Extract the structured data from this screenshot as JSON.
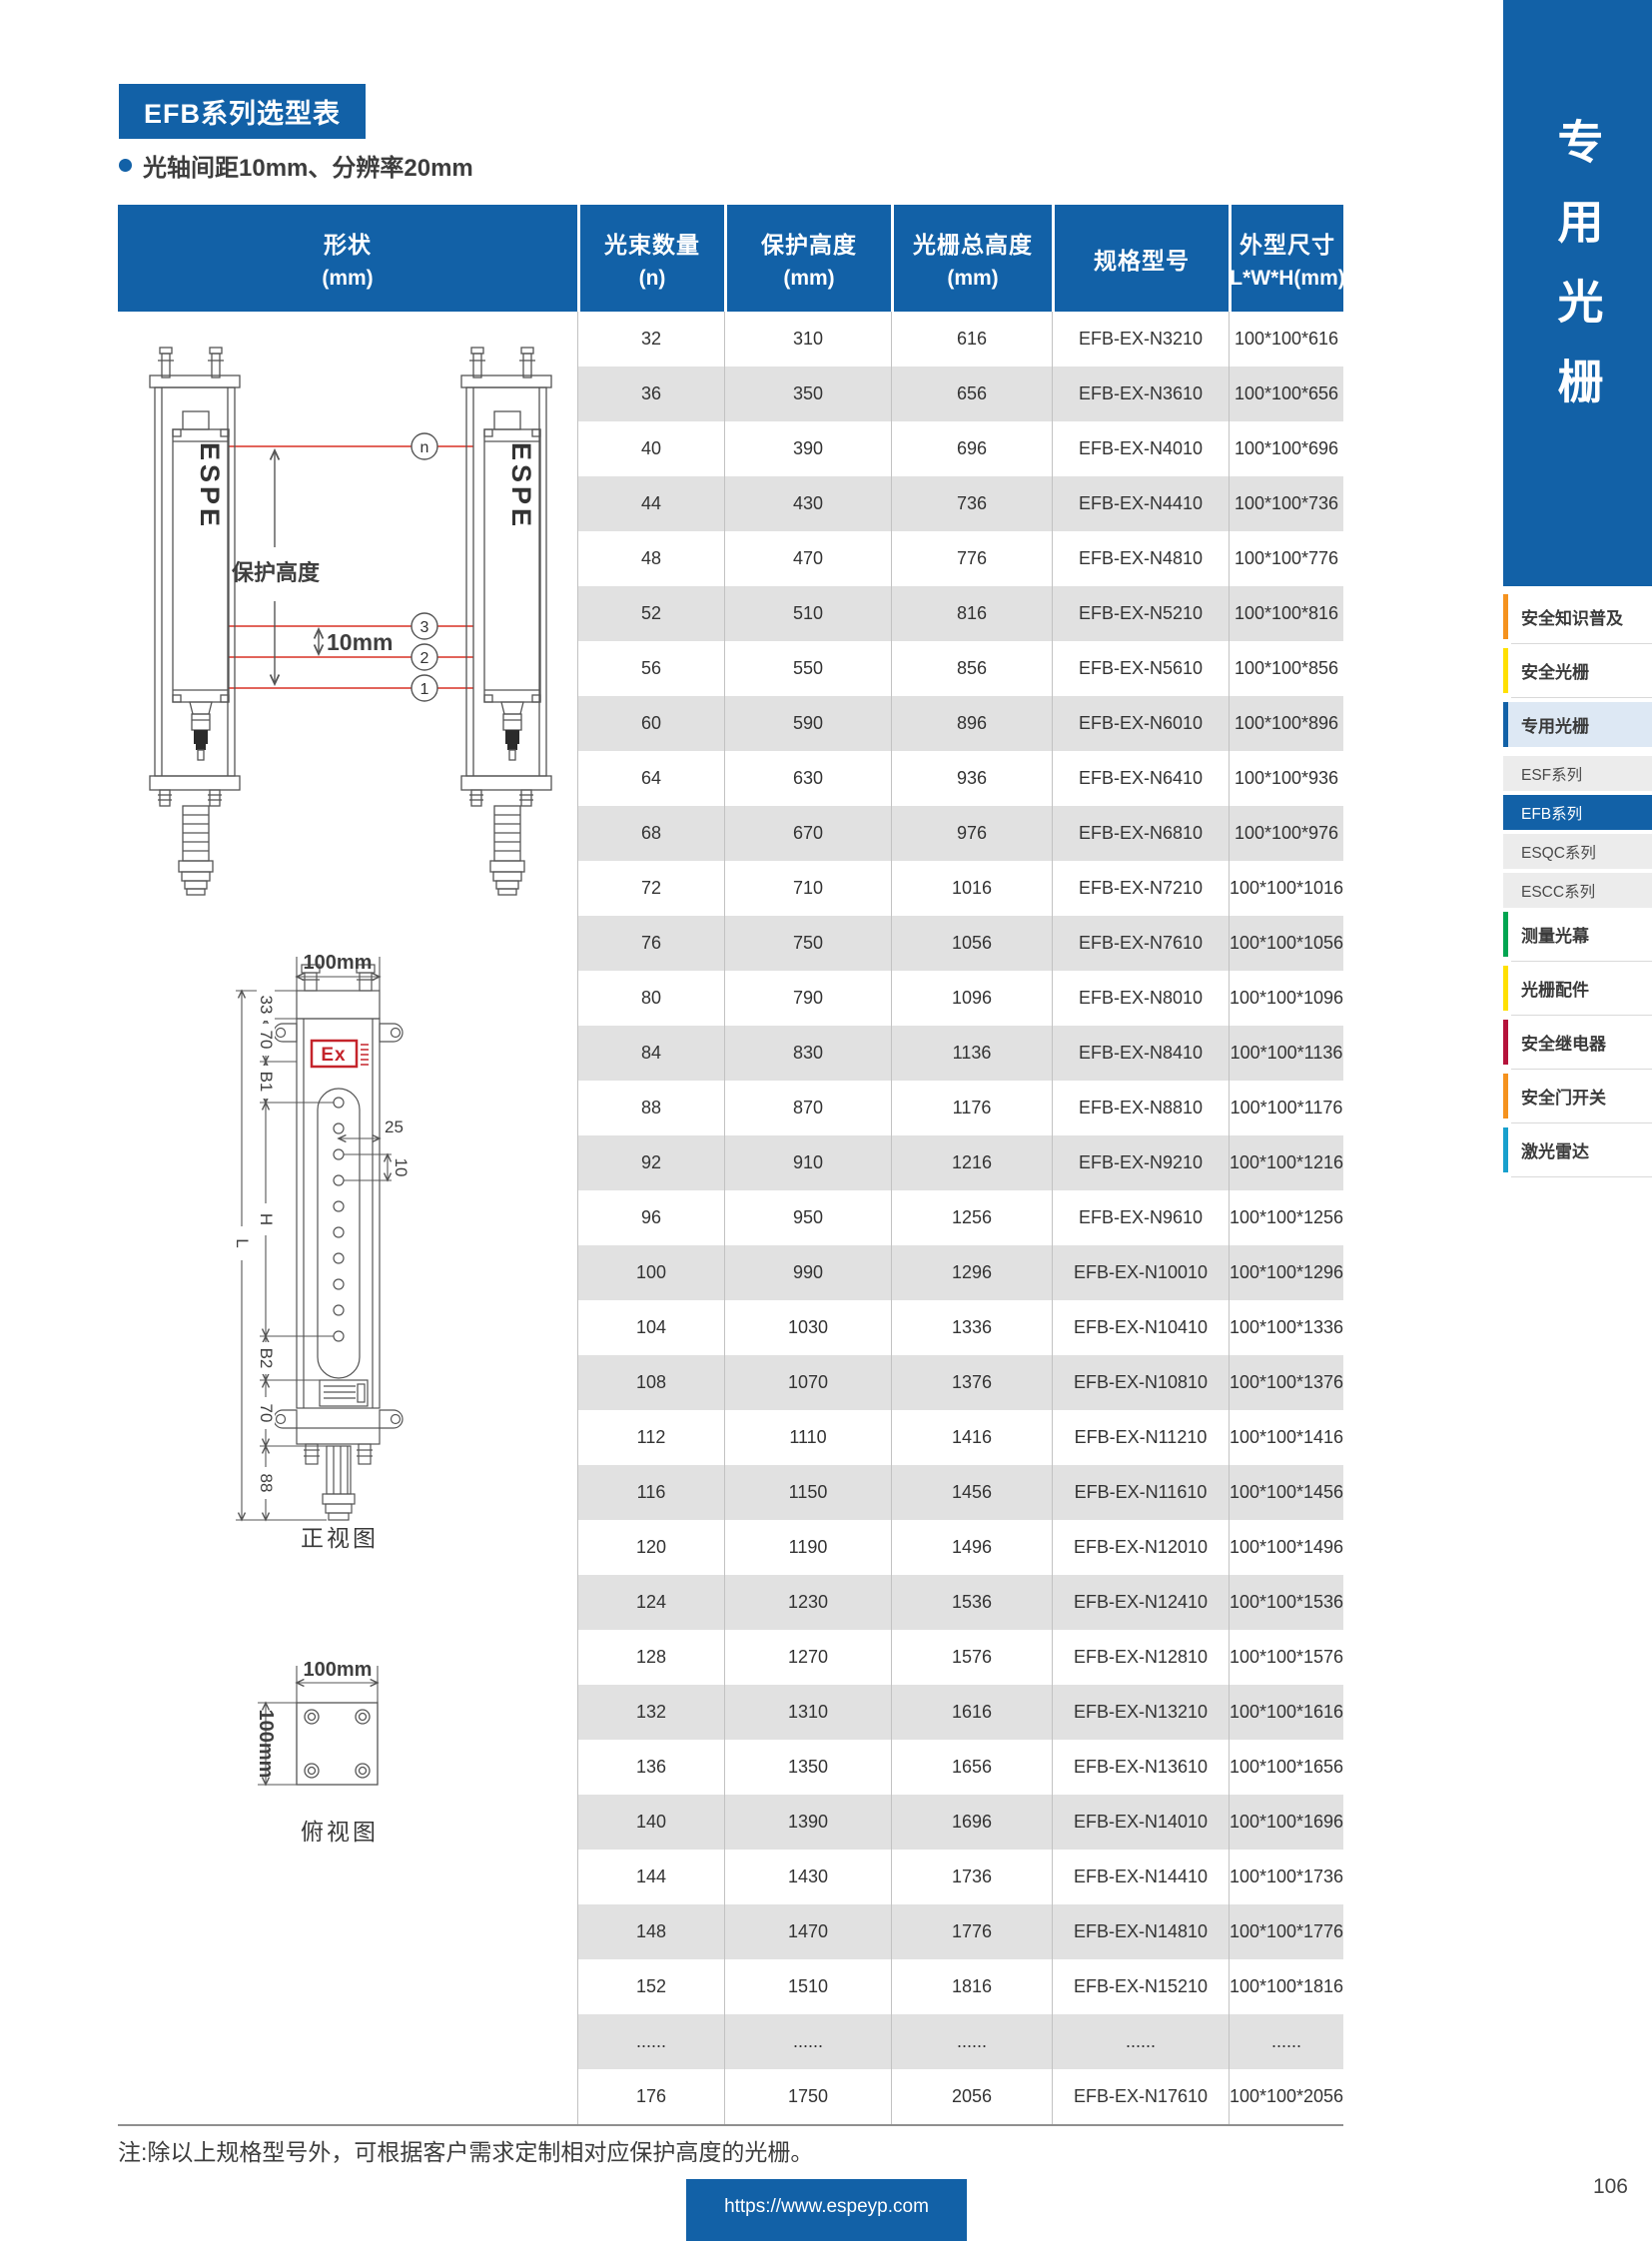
{
  "page": {
    "title": "EFB系列选型表",
    "subtitle": "光轴间距10mm、分辨率20mm",
    "note": "注:除以上规格型号外，可根据客户需求定制相对应保护高度的光栅。",
    "footer_url": "https://www.espeyp.com",
    "page_number": "106"
  },
  "table": {
    "headers": [
      {
        "line1": "形状",
        "line2": "(mm)"
      },
      {
        "line1": "光束数量",
        "line2": "(n)"
      },
      {
        "line1": "保护高度",
        "line2": "(mm)"
      },
      {
        "line1": "光栅总高度",
        "line2": "(mm)"
      },
      {
        "line1": "规格型号",
        "line2": ""
      },
      {
        "line1": "外型尺寸",
        "line2": "L*W*H(mm)"
      }
    ],
    "rows": [
      [
        "32",
        "310",
        "616",
        "EFB-EX-N3210",
        "100*100*616"
      ],
      [
        "36",
        "350",
        "656",
        "EFB-EX-N3610",
        "100*100*656"
      ],
      [
        "40",
        "390",
        "696",
        "EFB-EX-N4010",
        "100*100*696"
      ],
      [
        "44",
        "430",
        "736",
        "EFB-EX-N4410",
        "100*100*736"
      ],
      [
        "48",
        "470",
        "776",
        "EFB-EX-N4810",
        "100*100*776"
      ],
      [
        "52",
        "510",
        "816",
        "EFB-EX-N5210",
        "100*100*816"
      ],
      [
        "56",
        "550",
        "856",
        "EFB-EX-N5610",
        "100*100*856"
      ],
      [
        "60",
        "590",
        "896",
        "EFB-EX-N6010",
        "100*100*896"
      ],
      [
        "64",
        "630",
        "936",
        "EFB-EX-N6410",
        "100*100*936"
      ],
      [
        "68",
        "670",
        "976",
        "EFB-EX-N6810",
        "100*100*976"
      ],
      [
        "72",
        "710",
        "1016",
        "EFB-EX-N7210",
        "100*100*1016"
      ],
      [
        "76",
        "750",
        "1056",
        "EFB-EX-N7610",
        "100*100*1056"
      ],
      [
        "80",
        "790",
        "1096",
        "EFB-EX-N8010",
        "100*100*1096"
      ],
      [
        "84",
        "830",
        "1136",
        "EFB-EX-N8410",
        "100*100*1136"
      ],
      [
        "88",
        "870",
        "1176",
        "EFB-EX-N8810",
        "100*100*1176"
      ],
      [
        "92",
        "910",
        "1216",
        "EFB-EX-N9210",
        "100*100*1216"
      ],
      [
        "96",
        "950",
        "1256",
        "EFB-EX-N9610",
        "100*100*1256"
      ],
      [
        "100",
        "990",
        "1296",
        "EFB-EX-N10010",
        "100*100*1296"
      ],
      [
        "104",
        "1030",
        "1336",
        "EFB-EX-N10410",
        "100*100*1336"
      ],
      [
        "108",
        "1070",
        "1376",
        "EFB-EX-N10810",
        "100*100*1376"
      ],
      [
        "112",
        "1110",
        "1416",
        "EFB-EX-N11210",
        "100*100*1416"
      ],
      [
        "116",
        "1150",
        "1456",
        "EFB-EX-N11610",
        "100*100*1456"
      ],
      [
        "120",
        "1190",
        "1496",
        "EFB-EX-N12010",
        "100*100*1496"
      ],
      [
        "124",
        "1230",
        "1536",
        "EFB-EX-N12410",
        "100*100*1536"
      ],
      [
        "128",
        "1270",
        "1576",
        "EFB-EX-N12810",
        "100*100*1576"
      ],
      [
        "132",
        "1310",
        "1616",
        "EFB-EX-N13210",
        "100*100*1616"
      ],
      [
        "136",
        "1350",
        "1656",
        "EFB-EX-N13610",
        "100*100*1656"
      ],
      [
        "140",
        "1390",
        "1696",
        "EFB-EX-N14010",
        "100*100*1696"
      ],
      [
        "144",
        "1430",
        "1736",
        "EFB-EX-N14410",
        "100*100*1736"
      ],
      [
        "148",
        "1470",
        "1776",
        "EFB-EX-N14810",
        "100*100*1776"
      ],
      [
        "152",
        "1510",
        "1816",
        "EFB-EX-N15210",
        "100*100*1816"
      ],
      [
        "......",
        "......",
        "......",
        "......",
        "......"
      ],
      [
        "176",
        "1750",
        "2056",
        "EFB-EX-N17610",
        "100*100*2056"
      ]
    ]
  },
  "diagram": {
    "brand": "ESPE",
    "protection_height_label": "保护高度",
    "beam_pitch_label": "10mm",
    "beam_labels": [
      "n",
      "3",
      "2",
      "1"
    ],
    "front_view": {
      "caption": "正视图",
      "width_label": "100mm",
      "ex_label": "Ex",
      "dims_left": [
        "33",
        "70",
        "B1",
        "L",
        "H",
        "B2",
        "70",
        "88"
      ],
      "dims_right": [
        "25",
        "10"
      ]
    },
    "top_view": {
      "caption": "俯视图",
      "width_label": "100mm",
      "height_label": "100mm"
    }
  },
  "sidebar": {
    "vertical_title": "专用光栅",
    "items": [
      {
        "label": "安全知识普及",
        "type": "bar",
        "color": "#f5921e"
      },
      {
        "label": "安全光栅",
        "type": "bar",
        "color": "#ffe000"
      },
      {
        "label": "专用光栅",
        "type": "bar-active",
        "color": "#1261a7"
      },
      {
        "label": "ESF系列",
        "type": "sub",
        "color": ""
      },
      {
        "label": "EFB系列",
        "type": "sub-active",
        "color": ""
      },
      {
        "label": "ESQC系列",
        "type": "sub",
        "color": ""
      },
      {
        "label": "ESCC系列",
        "type": "sub",
        "color": ""
      },
      {
        "label": "测量光幕",
        "type": "bar",
        "color": "#00a551"
      },
      {
        "label": "光栅配件",
        "type": "bar",
        "color": "#ffe000"
      },
      {
        "label": "安全继电器",
        "type": "bar",
        "color": "#b5123b"
      },
      {
        "label": "安全门开关",
        "type": "bar",
        "color": "#f5921e"
      },
      {
        "label": "激光雷达",
        "type": "bar",
        "color": "#18a0cd"
      }
    ]
  },
  "colors": {
    "primary_blue": "#1261a7",
    "active_item_bg": "#dde8f4",
    "row_alt_gray": "#e1e1e1",
    "menu_item_gray": "#ececec",
    "beam_red": "#d93025",
    "ex_red": "#c4242b"
  }
}
